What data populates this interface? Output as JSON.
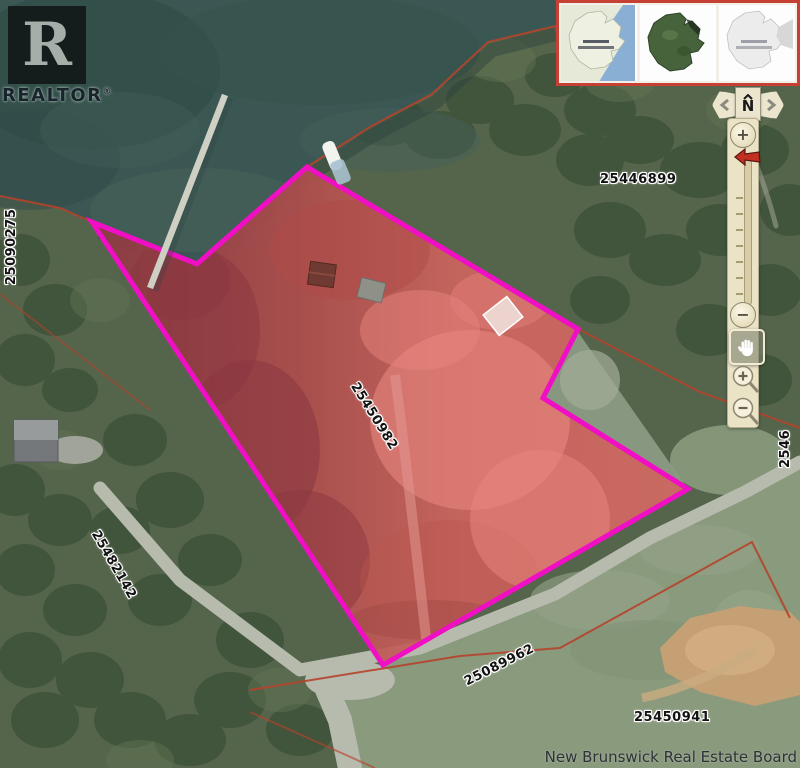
{
  "logo": {
    "letter": "R",
    "brand": "REALTOR",
    "registered": "®"
  },
  "inset_maps": [
    {
      "name": "street-locator-map"
    },
    {
      "name": "satellite-locator-map"
    },
    {
      "name": "grayscale-locator-map"
    }
  ],
  "controls": {
    "north": "N",
    "slider_zoom_in": "+",
    "slider_zoom_out": "−"
  },
  "pids": {
    "top": "25446899",
    "subject": "25450982",
    "left_shore": "25090275",
    "left_road": "25482142",
    "road": "25089962",
    "bottom_right": "25450941",
    "right_edge": "2546"
  },
  "attribution": "New Brunswick Real Estate Board",
  "colors": {
    "parcel_outline": "#f00fc4",
    "parcel_fill_tint": "rgba(225,30,50,0.25)",
    "cadastral_line": "#b5432c",
    "water": "#3b5753",
    "road": "#b7bbae"
  }
}
